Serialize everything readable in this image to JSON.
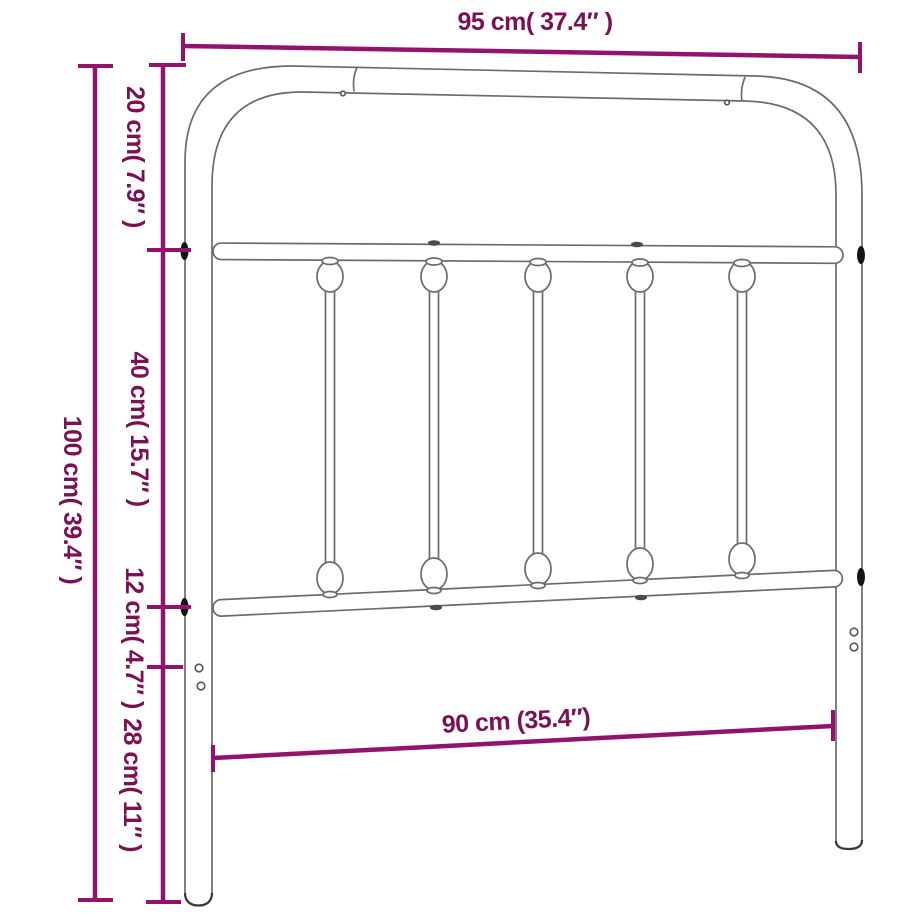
{
  "diagram_title": "Metal headboard dimension diagram",
  "labels": {
    "top_width": "95 cm( 37.4″ )",
    "total_height": "100 cm( 39.4″ )",
    "seg_20": "20 cm( 7.9″ )",
    "seg_40": "40 cm( 15.7″ )",
    "seg_12": "12 cm( 4.7″ )",
    "seg_28": "28 cm( 11″ )",
    "bottom_width": "90 cm (35.4″)"
  },
  "measurements": [
    {
      "name": "top-width",
      "cm": 95,
      "inches": 37.4,
      "label": "95 cm( 37.4″ )"
    },
    {
      "name": "total-height",
      "cm": 100,
      "inches": 39.4,
      "label": "100 cm( 39.4″ )"
    },
    {
      "name": "top-segment",
      "cm": 20,
      "inches": 7.9,
      "label": "20 cm( 7.9″ )"
    },
    {
      "name": "spindle-segment",
      "cm": 40,
      "inches": 15.7,
      "label": "40 cm( 15.7″ )"
    },
    {
      "name": "lower-bar-segment",
      "cm": 12,
      "inches": 4.7,
      "label": "12 cm( 4.7″ )"
    },
    {
      "name": "leg-segment",
      "cm": 28,
      "inches": 11,
      "label": "28 cm( 11″ )"
    },
    {
      "name": "inner-width",
      "cm": 90,
      "inches": 35.4,
      "label": "90 cm (35.4″)"
    }
  ],
  "colors": {
    "dimension_line": "#92126E",
    "dimension_text": "#7B1054",
    "frame_outline": "#6B6B6B",
    "joint_marker": "#151515",
    "background": "#FFFFFF"
  }
}
